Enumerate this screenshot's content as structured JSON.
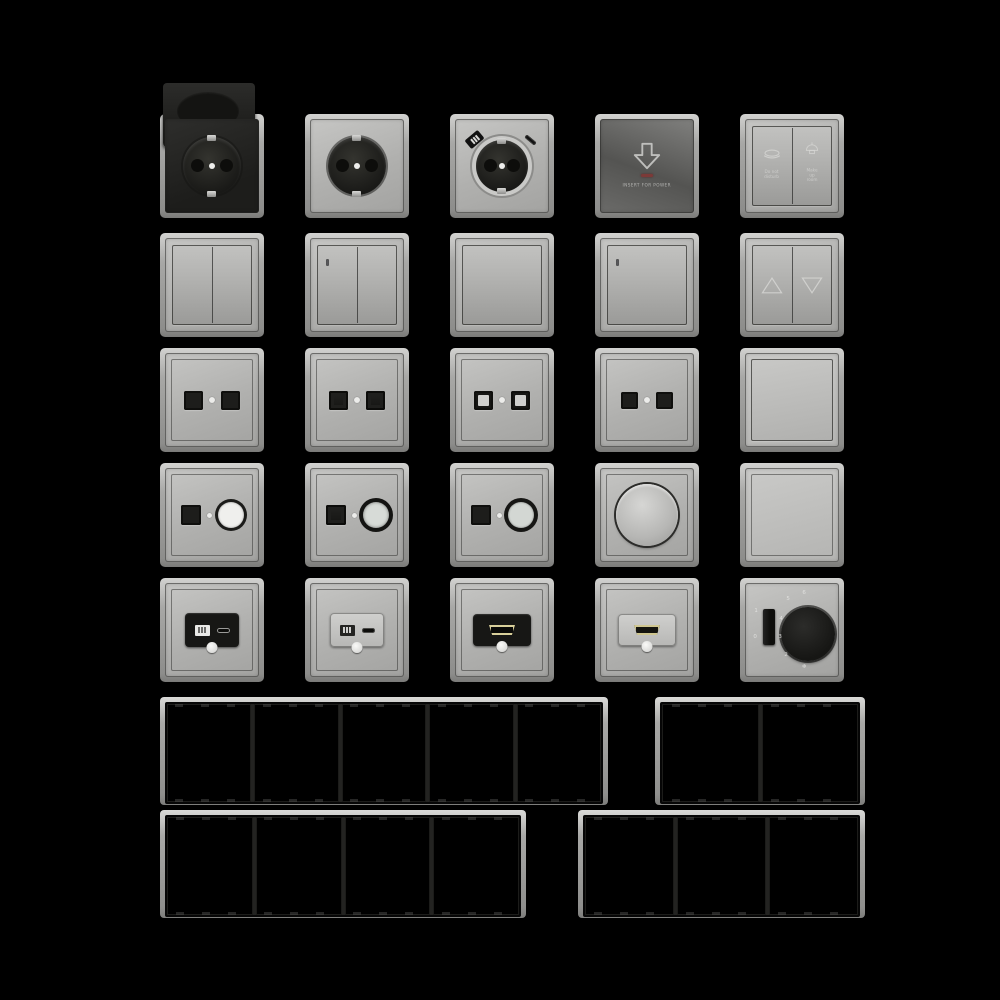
{
  "palette": {
    "background": "#000000",
    "plate_gray": "#b2b2b0",
    "frame_metal": "#9c9c9a",
    "insert_black": "#1a1a18",
    "led_red": "#7c3a38",
    "engraving": "#d8d8d6"
  },
  "card_switch": {
    "label": "INSERT FOR POWER"
  },
  "hotel_switch": {
    "left_line1": "Do not",
    "left_line2": "disturb",
    "right_line1": "Make up",
    "right_line2": "room"
  },
  "thermostat": {
    "slider_top": "1",
    "slider_bottom": "0",
    "dial_marks": [
      "6",
      "5",
      "4",
      "3",
      "2"
    ],
    "mode_icon": "❄"
  },
  "frames": {
    "top_left_gangs": 5,
    "top_right_gangs": 2,
    "bottom_left_gangs": 4,
    "bottom_right_gangs": 3
  }
}
